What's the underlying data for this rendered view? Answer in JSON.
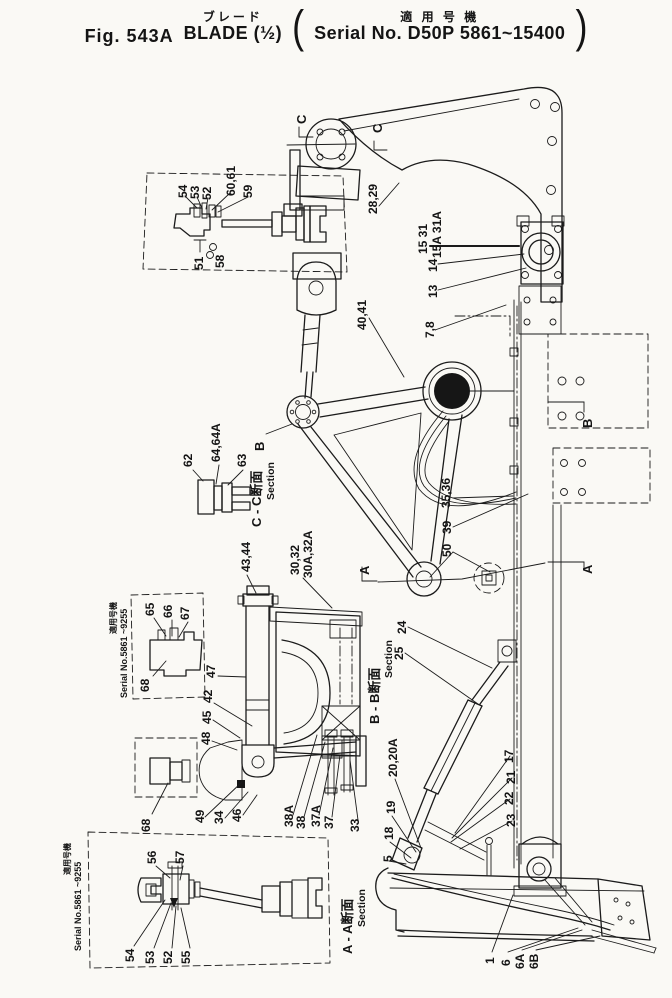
{
  "header": {
    "fig": "Fig. 543A",
    "title_jp": "ブレード",
    "title_en": "BLADE (½)",
    "paren_jp": "適 用 号 機",
    "paren_en": "Serial No. D50P 5861~15400"
  },
  "sections": {
    "cc": "C - C断面",
    "bb": "B - B断面",
    "aa": "A - A断面",
    "section": "Section",
    "marker_a": "A",
    "marker_b": "B",
    "marker_c": "C"
  },
  "serial_note": {
    "jp": "適用号機",
    "en": "Serial No.5861 ~9255"
  },
  "callouts": {
    "t54": "54",
    "t53": "53",
    "t52": "52",
    "t6061": "60,61",
    "t59": "59",
    "t51": "51",
    "t58": "58",
    "t2829": "28,29",
    "t1531": "15 31",
    "t15a31a": "15A 31A",
    "t14": "14",
    "t13": "13",
    "t78": "7,8",
    "t4041": "40,41",
    "t62": "62",
    "t6464a": "64,64A",
    "t63": "63",
    "t4344": "43,44",
    "t3032": "30,32",
    "t30a32a": "30A,32A",
    "t3536": "35,36",
    "t39": "39",
    "t50": "50",
    "t65": "65",
    "t66": "66",
    "t67": "67",
    "t68a": "68",
    "t68b": "68",
    "t47": "47",
    "t42": "42",
    "t45": "45",
    "t48": "48",
    "t49": "49",
    "t34": "34",
    "t46": "46",
    "t38a": "38A",
    "t38": "38",
    "t37a": "37A",
    "t37": "37",
    "t33": "33",
    "t24": "24",
    "t25": "25",
    "t2020a": "20,20A",
    "t19": "19",
    "t18": "18",
    "t5": "5",
    "t17": "17",
    "t21": "21",
    "t22": "22",
    "t23": "23",
    "t56": "56",
    "t57": "57",
    "t54b": "54",
    "t53b": "53",
    "t52b": "52",
    "t55": "55",
    "t1": "1",
    "t6": "6",
    "t6a": "6A",
    "t6b": "6B"
  }
}
